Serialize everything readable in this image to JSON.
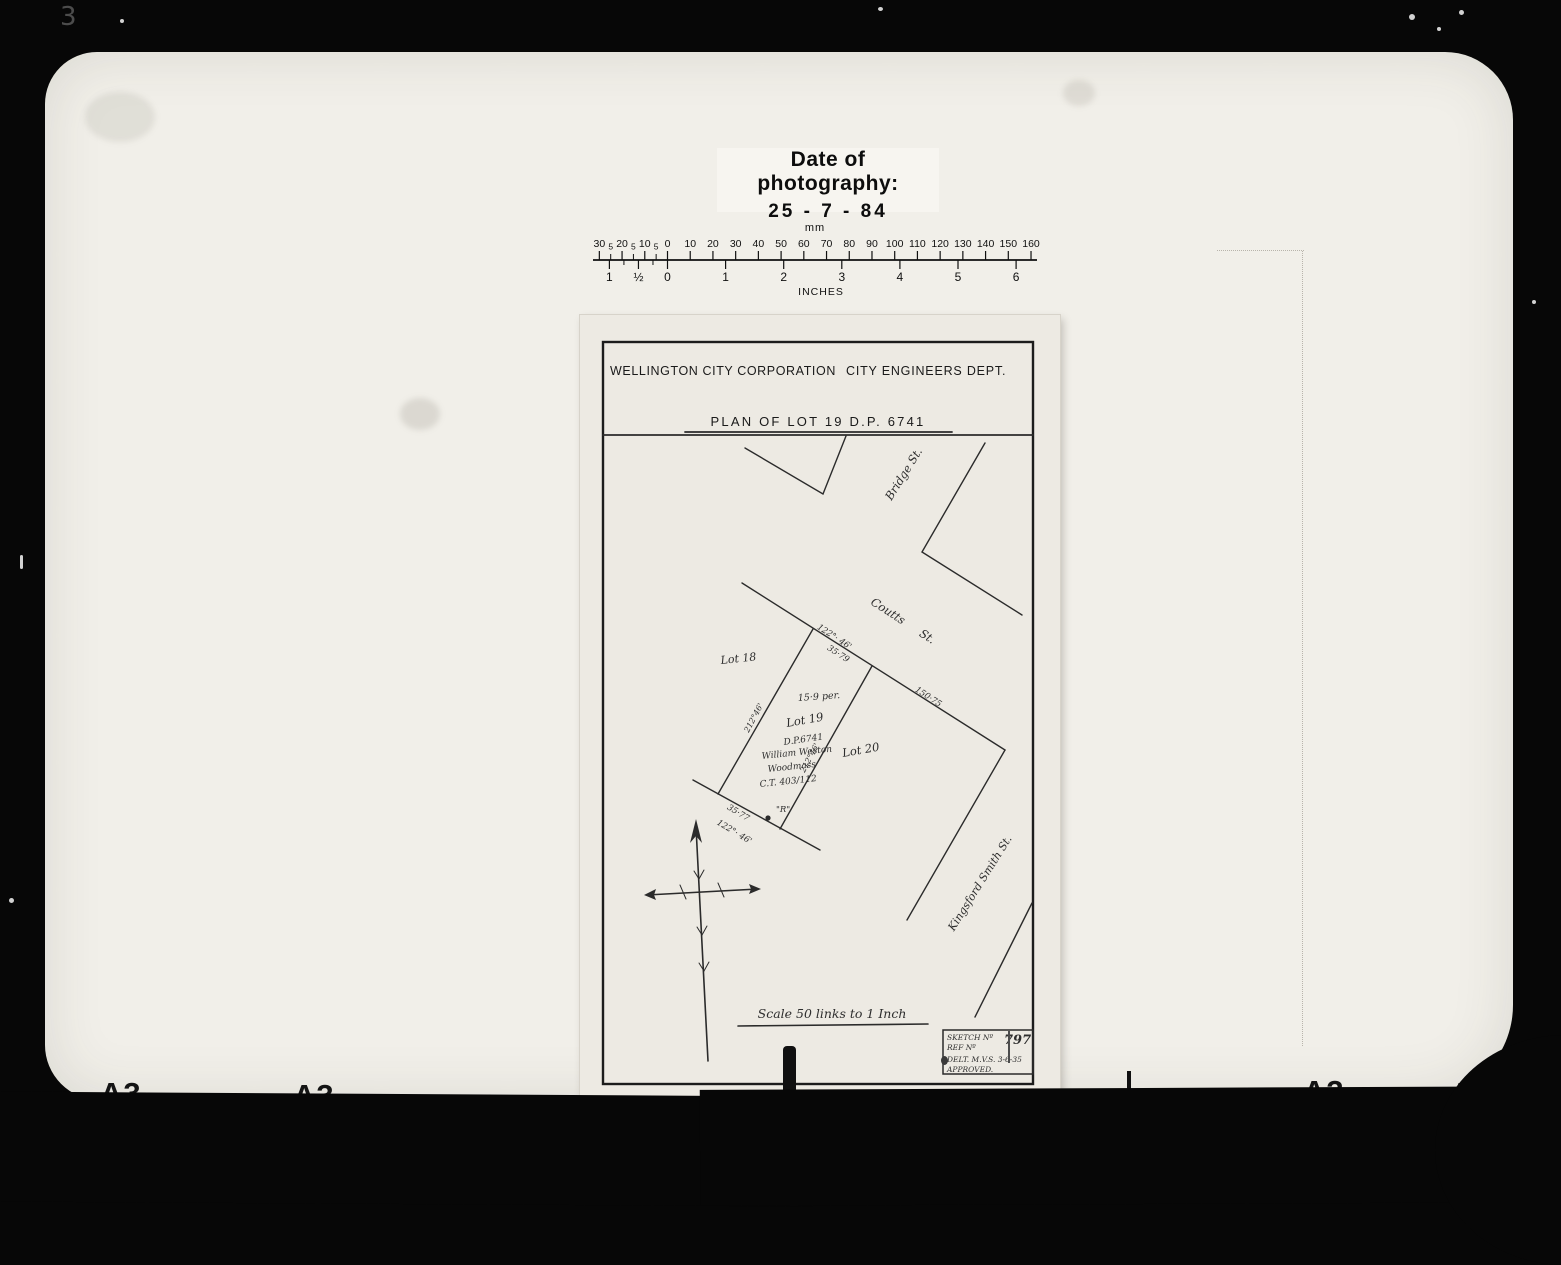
{
  "photo": {
    "date_label": "Date of photography:",
    "date_value": "25 - 7 - 84",
    "frame_marks": [
      "A3",
      "A3",
      "A3",
      "A3"
    ],
    "scratch": "3"
  },
  "ruler": {
    "mm_caption": "mm",
    "inches_caption": "INCHES",
    "mm_left_labels": [
      "30",
      "5",
      "20",
      "5",
      "10",
      "5"
    ],
    "mm_right_labels": [
      "0",
      "10",
      "20",
      "30",
      "40",
      "50",
      "60",
      "70",
      "80",
      "90",
      "100",
      "110",
      "120",
      "130",
      "140",
      "150",
      "160"
    ],
    "inch_labels": [
      "1",
      "½",
      "0",
      "1",
      "2",
      "3",
      "4",
      "5",
      "6"
    ]
  },
  "plan": {
    "org_left": "WELLINGTON CITY CORPORATION",
    "org_right": "CITY ENGINEERS DEPT.",
    "title": "PLAN OF LOT 19 D.P. 6741",
    "streets": {
      "bridge": "Bridge St.",
      "coutts": "Coutts St.",
      "kingsford": "Kingsford Smith St."
    },
    "lots": {
      "lot18": "Lot 18",
      "lot19": "Lot 19",
      "lot20": "Lot 20",
      "dp": "D.P.6741",
      "area": "15·9 per.",
      "owner1": "William Weston",
      "owner2": "Woodmass",
      "ct": "C.T. 403/112"
    },
    "dims": {
      "frontage_bearing": "122°· 46'",
      "frontage_len": "35·79",
      "coutts_len": "150·75",
      "side_left": "212°46'",
      "side_right": "212°46'",
      "rear_len": "35·77",
      "rear_bearing": "122°· 46'",
      "peg": "\"R\""
    },
    "scale_note": "Scale 50 links to 1 Inch",
    "sketch_box": {
      "l1": "SKETCH Nº",
      "no": "797",
      "l2": "REF Nº",
      "l3": "DELT. M.V.S. 3-6-35",
      "l4": "APPROVED."
    }
  }
}
